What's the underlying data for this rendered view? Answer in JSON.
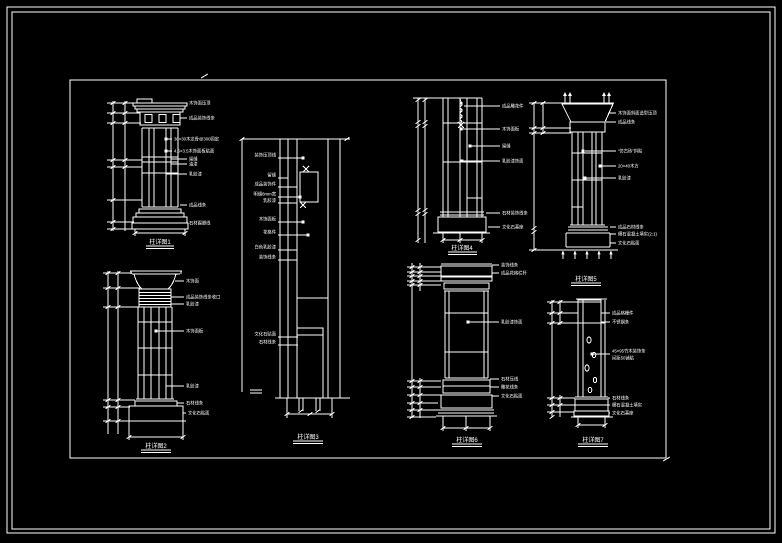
{
  "page": {
    "colors": {
      "background": "#000000",
      "line": "#ffffff"
    }
  },
  "drawings": {
    "d1": {
      "title": "柱详图1",
      "labels": [
        "木饰面压顶",
        "成品装饰线条",
        "30×30木龙骨@300固定",
        "4.5×3.5木饰面板贴面",
        "留缝",
        "油漆",
        "乳胶漆",
        "成品线条",
        "石材踢脚线"
      ]
    },
    "d2": {
      "title": "柱详图2",
      "labels": [
        "木饰面",
        "成品装饰线条收口",
        "乳胶漆",
        "木饰面板",
        "乳胶漆",
        "石材线条",
        "文化石贴面"
      ]
    },
    "d3": {
      "title": "柱详图3",
      "labels": [
        "装饰压顶线",
        "留缝",
        "成品装饰件",
        "明缝8mm宽",
        "乳胶漆",
        "木饰面板",
        "花格件",
        "白色乳胶漆",
        "装饰线条",
        "文化石贴面",
        "石材线条"
      ]
    },
    "d4": {
      "title": "柱详图4",
      "labels": [
        "成品雕花件",
        "木饰面板",
        "留缝",
        "乳胶漆饰面",
        "石材装饰线条",
        "文化石基座"
      ]
    },
    "d5": {
      "title": "柱详图5",
      "labels": [
        "木饰面斜面造型压顶",
        "成品线条",
        "“仿古砖”斜贴",
        "20×40木方",
        "乳胶漆",
        "成品石材线条",
        "细石混凝土填实(2:1)",
        "文化石贴面"
      ]
    },
    "d6": {
      "title": "柱详图6",
      "labels": [
        "装饰线条",
        "成品花格栏杆",
        "乳胶漆饰面",
        "石材压线",
        "雕花线条",
        "文化石贴面"
      ]
    },
    "d7": {
      "title": "柱详图7",
      "labels": [
        "成品格栅件",
        "不锈钢条",
        "45×95竹木装饰条",
        "间距50铺贴",
        "石材线条",
        "细石混凝土填实",
        "文化石基座"
      ]
    }
  }
}
